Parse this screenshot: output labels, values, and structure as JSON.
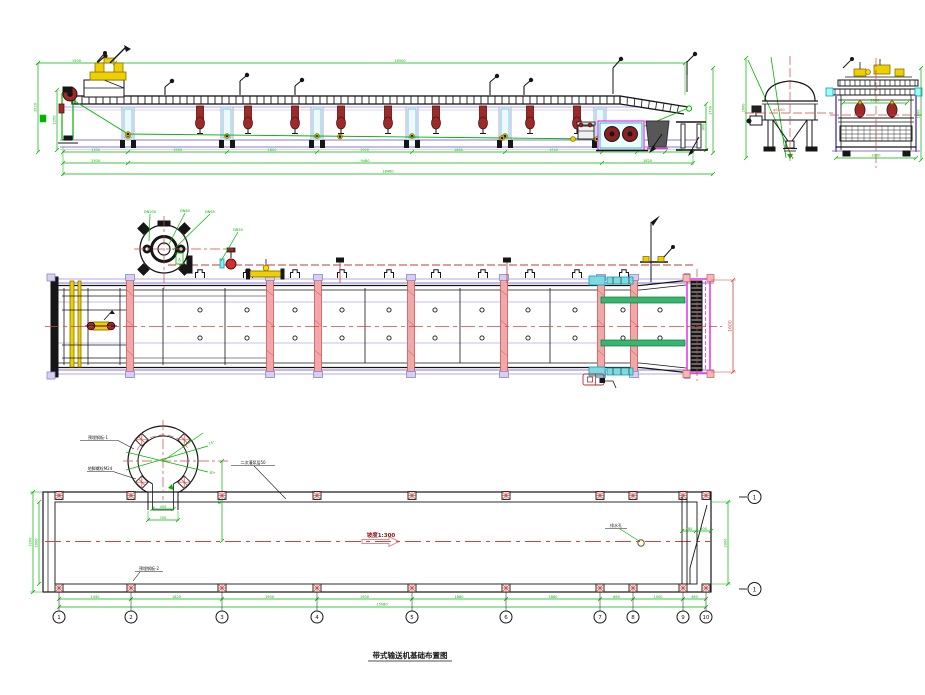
{
  "drawing": {
    "title": "带式输送机基础布置图",
    "background": "#ffffff"
  },
  "palette": {
    "dim_green": "#00b400",
    "centerline_red": "#d04545",
    "dark_red_fill": "#9b2b2b",
    "dark_red_stroke": "#5a1010",
    "purple": "#8878cc",
    "lavender": "#b3aae6",
    "magenta": "#e830e8",
    "cyan_stroke": "#11a0b4",
    "cyan_fill": "#aee9ef",
    "yellow_fill": "#edd000",
    "yellow_stroke": "#8a7000",
    "pink_fill": "#f0a8a8",
    "pink_stroke": "#cc5555",
    "black": "#161616"
  },
  "elevation": {
    "top_dims": [
      "1500",
      "16500"
    ],
    "left_height_dims": [
      "1520",
      "1250"
    ],
    "right_height_dim": "1700",
    "stand_dim": "900",
    "row1_dims": [
      "1300",
      "1980",
      "1800",
      "1900",
      "1860",
      "1940",
      "700",
      "560",
      "560"
    ],
    "row2_dims": [
      "1300",
      "9480",
      "1820"
    ],
    "overall_dim": "18460"
  },
  "end_view": {
    "tank_height_dim": "2600",
    "tank_dia_label": "φ1200",
    "inner_width_dim": "1500",
    "outer_width_dim": "2200",
    "height_dim": "1800"
  },
  "plan": {
    "leader_labels": [
      "DN200",
      "DN80",
      "DN65",
      "DN50"
    ],
    "detail_tag": "A",
    "drum_width_dim": "1600"
  },
  "foundation": {
    "slope_label": "坡度1:300",
    "grid_labels": [
      "1",
      "2",
      "3",
      "4",
      "5",
      "6",
      "7",
      "8",
      "9",
      "10"
    ],
    "section_label": "1",
    "row1_dims": [
      "1440",
      "1820",
      "1900",
      "1900",
      "1880",
      "1880",
      "660",
      "1000",
      "460"
    ],
    "overall_dim": "15080",
    "left_dims": [
      "2000",
      "2200"
    ],
    "neck_width_dim": "400",
    "neck_outer_dim": "700",
    "angle_labels": [
      "15°",
      "30°"
    ],
    "offset_dim": "800",
    "right_dims": [
      "280",
      "300"
    ],
    "right_height_dim": "2000",
    "leaders": {
      "l1": "预埋钢板-1",
      "l2": "地脚螺栓M24",
      "l3": "二次灌浆层50",
      "l4": "预埋钢板-2",
      "l5": "排水孔"
    }
  }
}
